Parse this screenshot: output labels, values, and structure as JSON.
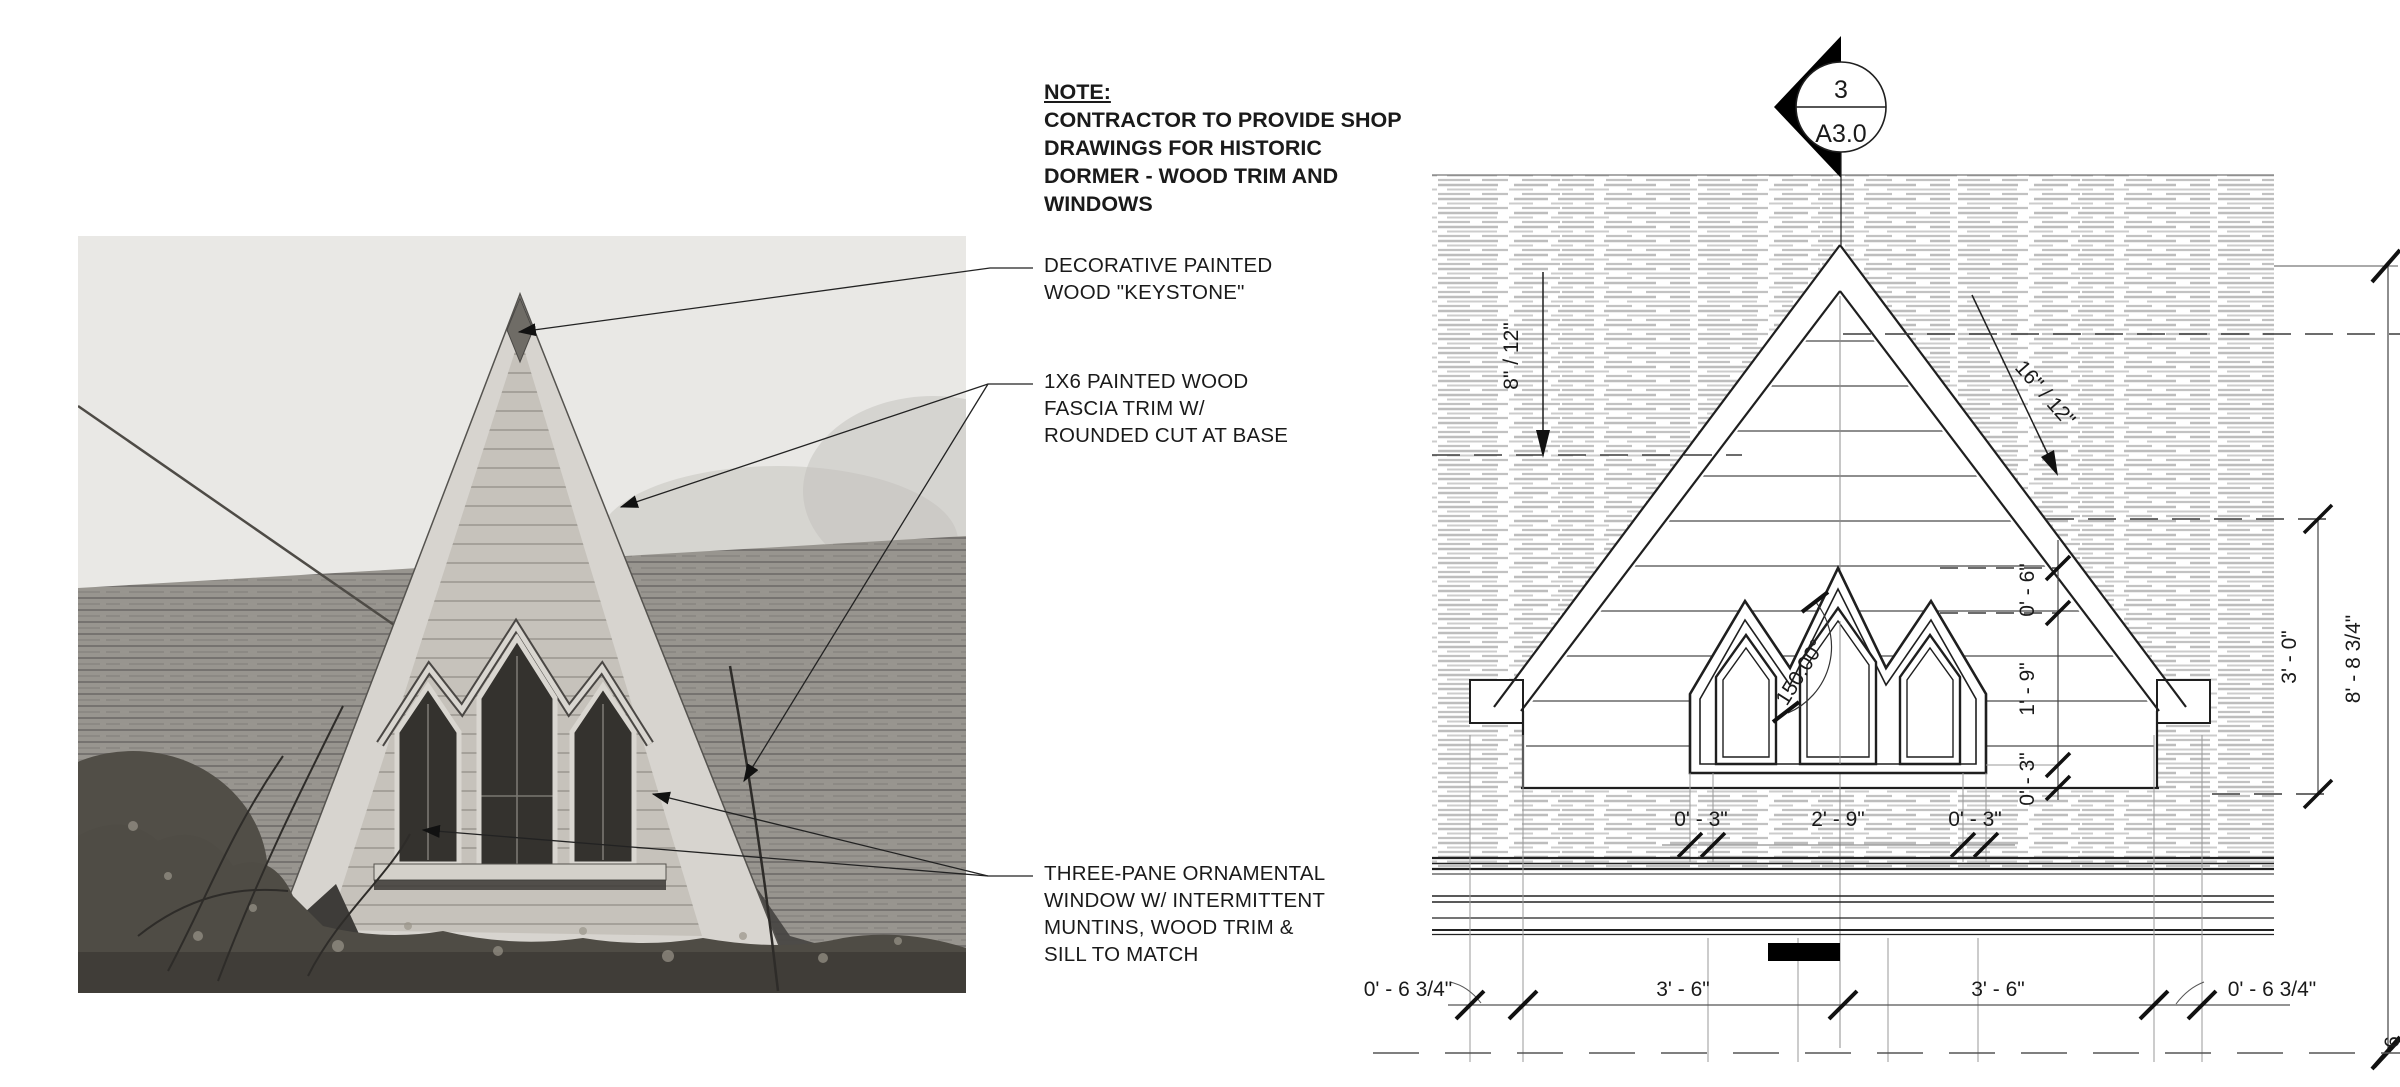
{
  "note": {
    "title": "NOTE:",
    "lines": [
      "CONTRACTOR TO PROVIDE SHOP",
      "DRAWINGS FOR HISTORIC",
      "DORMER - WOOD TRIM AND",
      "WINDOWS"
    ]
  },
  "callouts": {
    "keystone": {
      "lines": [
        "DECORATIVE PAINTED",
        "WOOD \"KEYSTONE\""
      ]
    },
    "fascia": {
      "lines": [
        "1X6 PAINTED WOOD",
        "FASCIA TRIM W/",
        "ROUNDED CUT AT BASE"
      ]
    },
    "window": {
      "lines": [
        "THREE-PANE ORNAMENTAL",
        "WINDOW W/ INTERMITTENT",
        "MUNTINS, WOOD TRIM &",
        "SILL TO MATCH"
      ]
    }
  },
  "section_marker": {
    "detail_number": "3",
    "sheet_number": "A3.0"
  },
  "dimensions": {
    "pitch_left": "8\" / 12\"",
    "pitch_right": "16\" / 12\"",
    "window_angle": "150.00°",
    "vertical_chain": [
      "0' - 6\"",
      "1' - 9\"",
      "0' - 3\""
    ],
    "right_overall_inner": "3' - 0\"",
    "right_overall_outer": "8' - 8 3/4\"",
    "window_row": [
      "0' - 3\"",
      "2' - 9\"",
      "0' - 3\""
    ],
    "bottom_row": [
      "0' - 6 3/4\"",
      "3' - 6\"",
      "3' - 6\"",
      "0' - 6 3/4\""
    ],
    "edge_partial": "6"
  },
  "colors": {
    "line": "#1f1f1f",
    "hatch": "#c4c4c4",
    "photo_sky": "#e9e8e5",
    "photo_roof": "#98958f",
    "photo_glass": "#34322e"
  }
}
